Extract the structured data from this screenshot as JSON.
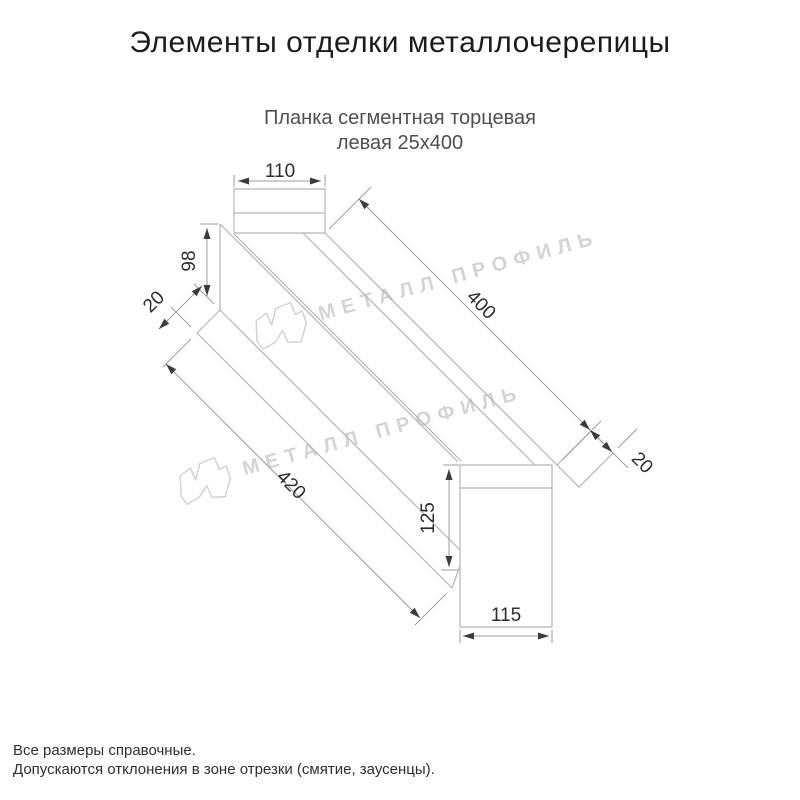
{
  "header": {
    "title": "Элементы отделки металлочерепицы"
  },
  "subtitle": {
    "line1": "Планка сегментная торцевая",
    "line2": "левая 25х400"
  },
  "drawing": {
    "type": "isometric technical drawing of left segmental end trim strip",
    "dimensions": {
      "top_tab_width": "110",
      "left_end_height": "98",
      "left_fold": "20",
      "length_top": "400",
      "right_fold": "20",
      "length_bottom": "420",
      "bottom_tab_height": "125",
      "bottom_tab_width": "115"
    },
    "colors": {
      "profile_line": "#b5b5b5",
      "dimension_line": "#9c9c9c",
      "dimension_text": "#2d2d2d",
      "arrow": "#3c3c3c"
    }
  },
  "watermark": {
    "text": "МЕТАЛЛ ПРОФИЛЬ",
    "logo": "metal-profil-logo",
    "color": "#d4d4d4"
  },
  "footer": {
    "line1": "Все размеры справочные.",
    "line2": "Допускаются отклонения в зоне отрезки (смятие, заусенцы)."
  }
}
